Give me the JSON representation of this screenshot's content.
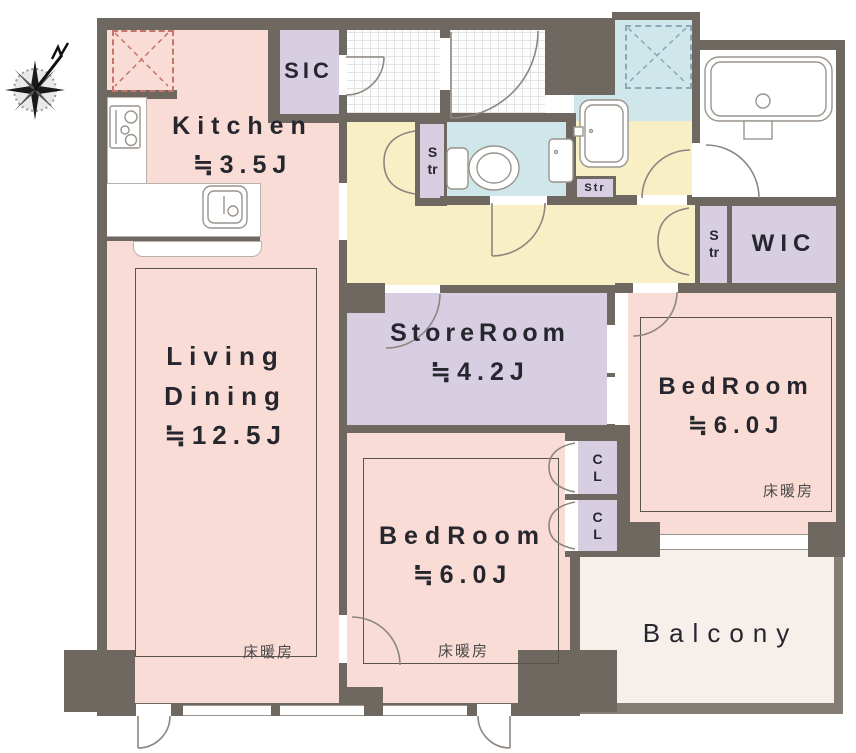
{
  "plan_title": "apartment floor plan",
  "colors": {
    "wall": "#6f6861",
    "room_pink": "#f9dcd5",
    "closet_purple": "#d7cee1",
    "hall_yellow": "#f9efc5",
    "wet_area_blue": "#cfe7ea",
    "balcony": "#f6efea"
  },
  "rooms": {
    "kitchen": {
      "name": "Kitchen",
      "size": "≒3.5J"
    },
    "living_dining": {
      "line1": "Living",
      "line2": "Dining",
      "size": "≒12.5J",
      "floor_heating": "床暖房"
    },
    "store_room": {
      "name": "StoreRoom",
      "size": "≒4.2J"
    },
    "bedroom_center": {
      "name": "BedRoom",
      "size": "≒6.0J",
      "floor_heating": "床暖房"
    },
    "bedroom_right": {
      "name": "BedRoom",
      "size": "≒6.0J",
      "floor_heating": "床暖房"
    },
    "balcony": {
      "name": "Balcony"
    },
    "sic": {
      "name": "SIC"
    },
    "wic": {
      "name": "WIC"
    }
  },
  "closets": {
    "str_hall": "Str",
    "str_washroom": "Str",
    "str_right": "Str",
    "cl_upper": "CL",
    "cl_lower": "CL"
  }
}
